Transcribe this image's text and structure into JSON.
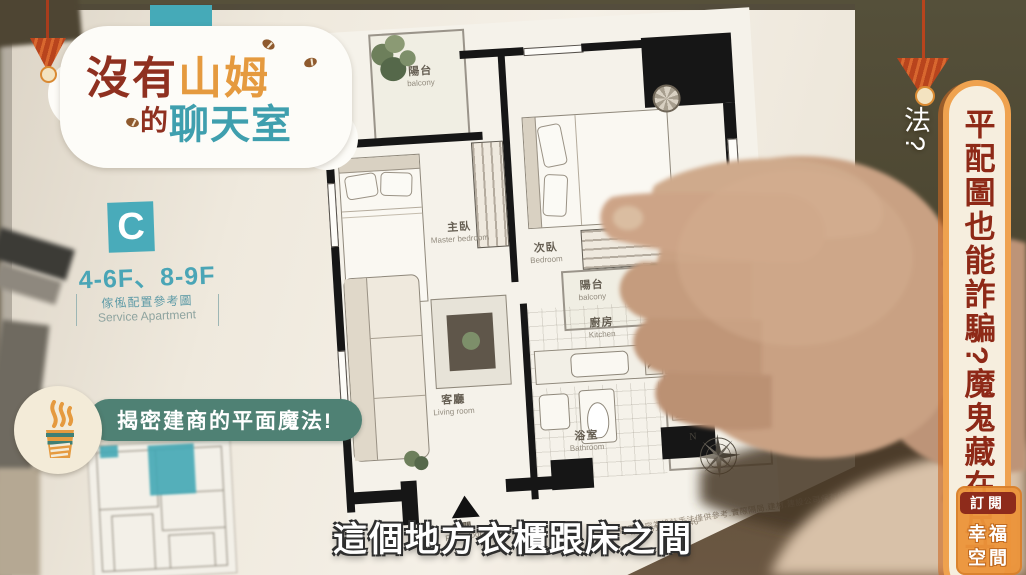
{
  "logo": {
    "line1_prefix": "沒有",
    "line1_highlight": "山姆",
    "line2_prefix": "的",
    "line2_highlight": "聊天室"
  },
  "overlays": {
    "headline_vertical": "平配圖也能詐騙?魔鬼藏在尺寸",
    "question_vertical_1": "神奇的規畫?",
    "question_vertical_2": "建商的平面圖魔法?",
    "badge_text": "揭密建商的平面魔法!",
    "subtitle": "這個地方衣櫃跟床之間",
    "subscribe": {
      "action": "訂閱",
      "brand_top": "幸福",
      "brand_bottom": "空間"
    }
  },
  "board_panel": {
    "unit_letter": "C",
    "floors": "4-6F、8-9F",
    "note_zh": "傢俬配置參考圖",
    "note_en": "Service Apartment"
  },
  "floorplan": {
    "rooms": [
      {
        "zh": "陽台",
        "en": "balcony"
      },
      {
        "zh": "主臥",
        "en": "Master bedroom"
      },
      {
        "zh": "次臥",
        "en": "Bedroom"
      },
      {
        "zh": "陽台",
        "en": "balcony"
      },
      {
        "zh": "廚房",
        "en": "Kitchen"
      },
      {
        "zh": "客廳",
        "en": "Living room"
      },
      {
        "zh": "浴室",
        "en": "Bathroom"
      },
      {
        "zh": "玄關",
        "en": "Front door"
      }
    ],
    "compass_label": "N",
    "disclaimer": "配置內容為設計手法僅供參考.實際隔局.建材.建設公司保有修改權.",
    "serial": "● 編號:6141306646"
  },
  "colors": {
    "brand_teal": "#45aab8",
    "badge_green": "#4f8174",
    "maroon": "#8e2b1b",
    "accent_orange": "#efa24f",
    "cream": "#f6eede"
  }
}
